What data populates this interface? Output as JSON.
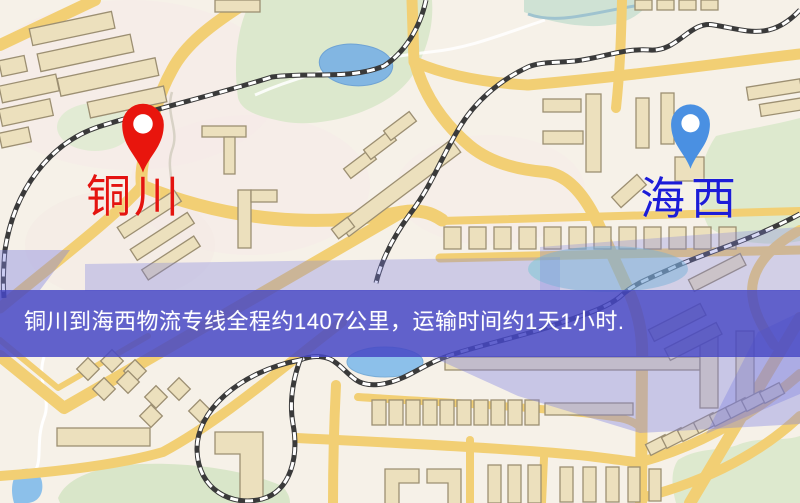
{
  "banner": {
    "text": "铜川到海西物流专线全程约1407公里，运输时间约1天1小时.",
    "background_color": "#4648c6",
    "text_color": "#ffffff"
  },
  "markers": {
    "origin": {
      "label": "铜川",
      "label_color": "#e41410",
      "pin_color": "#e8150d",
      "icon": "map-pin-icon"
    },
    "destination": {
      "label": "海西",
      "label_color": "#1c1cd8",
      "pin_color": "#4a90e2",
      "icon": "map-pin-icon"
    }
  },
  "route": {
    "origin_city": "铜川",
    "destination_city": "海西",
    "distance_text": "约1407公里",
    "duration_text": "约1天1小时"
  },
  "map": {
    "colors": {
      "background": "#f6f1e8",
      "road": "#f2cf74",
      "park": "#dce8cd",
      "water": "#85b8e2",
      "building_fill": "#ece0bd",
      "building_stroke": "#9c8f72",
      "railway": "#3a3a3a",
      "overlay_lavender": "#7d80e2"
    }
  }
}
